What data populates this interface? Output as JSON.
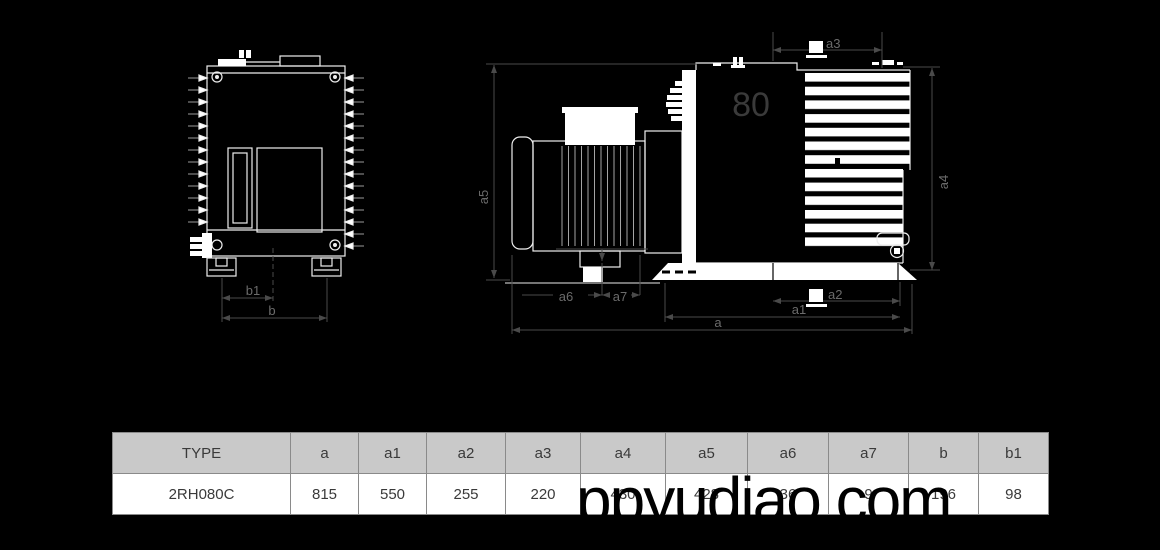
{
  "watermark": {
    "text": "ppyudiao.com"
  },
  "diagram": {
    "size_mark": "80",
    "labels": {
      "a": "a",
      "a1": "a1",
      "a2": "a2",
      "a3": "a3",
      "a4": "a4",
      "a5": "a5",
      "a6": "a6",
      "a7": "a7",
      "b": "b",
      "b1": "b1"
    }
  },
  "table": {
    "headers": [
      "TYPE",
      "a",
      "a1",
      "a2",
      "a3",
      "a4",
      "a5",
      "a6",
      "a7",
      "b",
      "b1"
    ],
    "rows": [
      [
        "2RH080C",
        "815",
        "550",
        "255",
        "220",
        "430",
        "428",
        "36",
        "9",
        "196",
        "98"
      ]
    ]
  },
  "colors": {
    "background": "#000000",
    "drawing_line": "#eeeeee",
    "dimension_line": "#4a4a4a",
    "dimension_text": "#6b6b6b",
    "size_mark_text": "#3a3a3a",
    "table_header_bg": "#c9c9c9",
    "table_border": "#8a8a8a",
    "table_text": "#3a3a3a",
    "watermark": "#000000"
  }
}
